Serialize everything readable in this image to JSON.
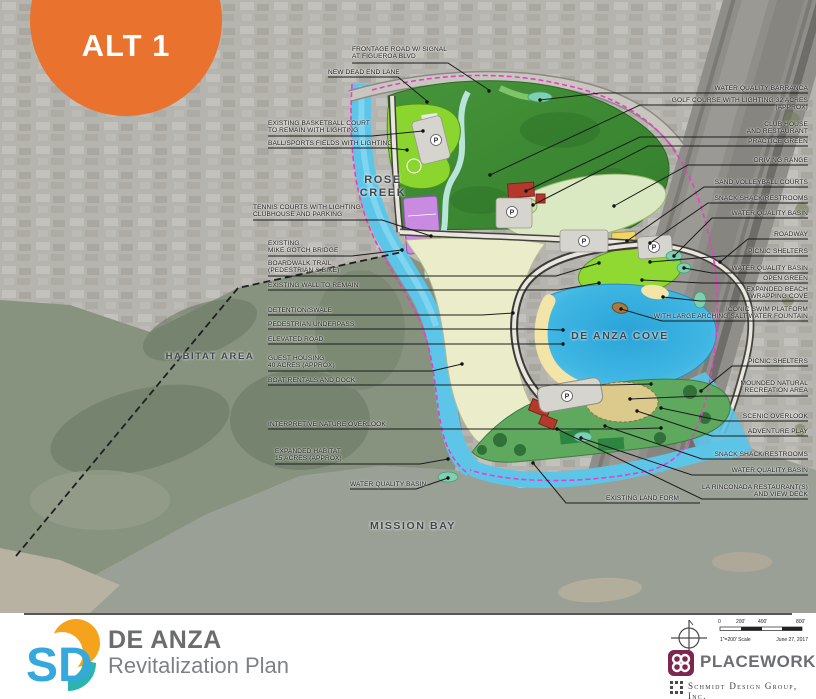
{
  "badge": {
    "label": "ALT 1",
    "color": "#E9722E"
  },
  "place_labels": {
    "rose_creek": "ROSE\nCREEK",
    "habitat_area": "HABITAT AREA",
    "de_anza_cove": "DE ANZA COVE",
    "mission_bay": "MISSION BAY"
  },
  "map": {
    "parking_label": "P"
  },
  "callouts": {
    "top": [
      "FRONTAGE ROAD W/ SIGNAL\nAT FIGUEROA BLVD",
      "NEW DEAD END LANE"
    ],
    "left": [
      "EXISTING BASKETBALL COURT\nTO REMAIN WITH LIGHTING",
      "BALL/SPORTS FIELDS WITH LIGHTING",
      "TENNIS COURTS WITH LIGHTING\nCLUBHOUSE AND PARKING",
      "EXISTING\nMIKE GOTCH BRIDGE",
      "BOARDWALK TRAIL\n(PEDESTRIAN & BIKE)",
      "EXISTING WALL TO REMAIN",
      "DETENTION/SWALE",
      "PEDESTRIAN UNDERPASS",
      "ELEVATED ROAD",
      "GUEST HOUSING\n40 ACRES (APPROX)",
      "BOAT RENTALS AND DOCK",
      "INTERPRETIVE NATURE OVERLOOK",
      "EXPANDED HABITAT\n15 ACRES (APPROX)",
      "WATER QUALITY BASIN",
      "EXISTING LAND FORM"
    ],
    "right": [
      "WATER QUALITY BARRANCA",
      "GOLF COURSE WITH LIGHTING 32 ACRES (APPROX)",
      "CLUB HOUSE\nAND RESTAURANT",
      "PRACTICE GREEN",
      "DRIVING RANGE",
      "SAND VOLLEYBALL COURTS",
      "SNACK SHACK/RESTROOMS",
      "WATER QUALITY BASIN",
      "ROADWAY",
      "PICNIC SHELTERS",
      "WATER QUALITY BASIN",
      "OPEN GREEN",
      "EXPANDED BEACH\nWRAPPING COVE",
      "ICONIC SWIM PLATFORM\nWITH LARGE ARCHING SALT WATER FOUNTAIN",
      "PICNIC SHELTERS",
      "MOUNDED NATURAL\nRECREATION AREA",
      "SCENIC OVERLOOK",
      "ADVENTURE PLAY",
      "SNACK SHACK/RESTROOMS",
      "WATER QUALITY BASIN",
      "LA RINCONADA RESTAURANT(S)\nAND VIEW DECK"
    ]
  },
  "footer": {
    "logo_text": "SD",
    "title": "DE ANZA",
    "subtitle": "Revitalization Plan",
    "scale": {
      "ticks": [
        "0",
        "200'",
        "400'",
        "800'"
      ],
      "label": "1\"=200' Scale",
      "date": "June 27, 2017"
    },
    "firms": {
      "placeworks": "PLACEWORKS",
      "schmidt": "Schmidt Design Group, Inc."
    }
  },
  "colors": {
    "badge_orange": "#E9722E",
    "cove_blue": "#3FB6E3",
    "channel_blue": "#5DC5E8",
    "golf_green": "#3A8A32",
    "field_lime": "#8BD62E",
    "beach_sand": "#F2E3A6",
    "guest_cream": "#EBECCA",
    "tennis_purple": "#C98AE2",
    "boundary_magenta": "#E83EC8",
    "placeworks_plum": "#7D2750",
    "sd_blue": "#35A8DE",
    "sd_orange": "#F5A31C",
    "sd_teal": "#2BB5AE"
  }
}
